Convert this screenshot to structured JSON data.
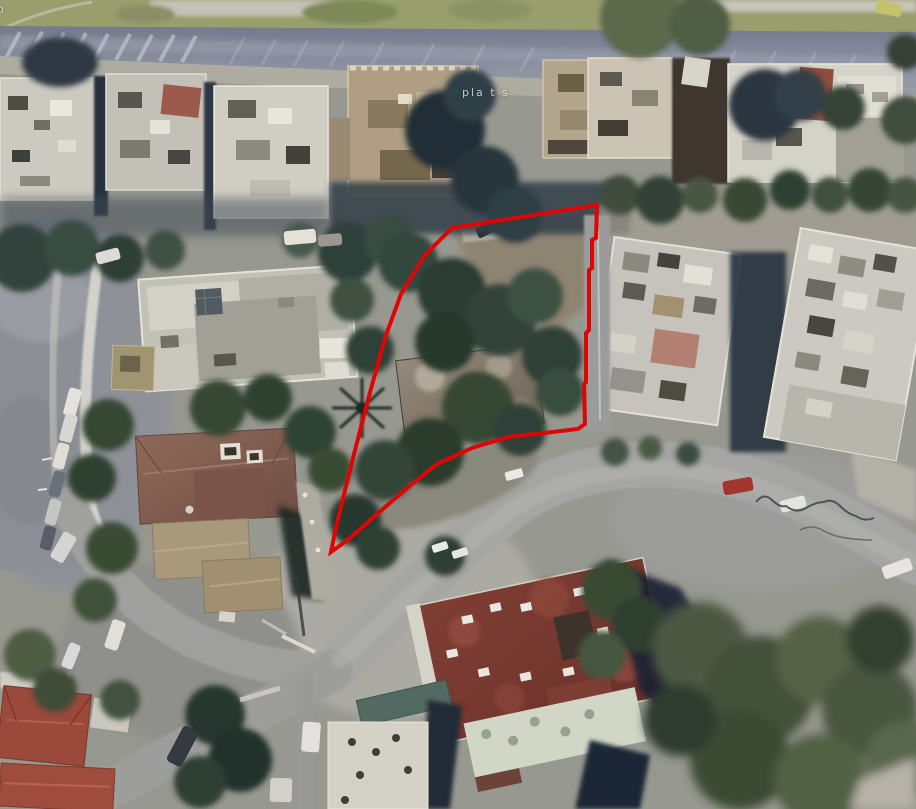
{
  "title": "aerial-property-map",
  "map": {
    "street_label": "pla t s",
    "corner_label": "0",
    "boundary": {
      "color": "#e00505",
      "stroke_width": 4,
      "points": [
        [
          452,
          228
        ],
        [
          597,
          205
        ],
        [
          596,
          238
        ],
        [
          592,
          240
        ],
        [
          592,
          268
        ],
        [
          589,
          270
        ],
        [
          589,
          330
        ],
        [
          586,
          333
        ],
        [
          586,
          382
        ],
        [
          584,
          384
        ],
        [
          585,
          424
        ],
        [
          578,
          429
        ],
        [
          544,
          433
        ],
        [
          508,
          437
        ],
        [
          472,
          448
        ],
        [
          437,
          464
        ],
        [
          406,
          489
        ],
        [
          376,
          515
        ],
        [
          349,
          539
        ],
        [
          331,
          552
        ],
        [
          336,
          527
        ],
        [
          352,
          462
        ],
        [
          369,
          396
        ],
        [
          385,
          338
        ],
        [
          401,
          294
        ],
        [
          425,
          255
        ],
        [
          452,
          228
        ]
      ]
    },
    "colors": {
      "boundary_red": "#e00505",
      "vegetation_dark": "#2c3e36",
      "vegetation_olive": "#4b5a3e",
      "road_gray": "#a7a8a4",
      "top_road_blue_gray": "#7d8494",
      "grass_strip_olive": "#9aa06b",
      "building_white": "#d4d2c6",
      "villa_roof_terracotta": "#8a6355",
      "bottom_building_roof": "#7c362c",
      "corner_roof_red": "#9c4636",
      "shadow_navy": "#16202e"
    }
  }
}
